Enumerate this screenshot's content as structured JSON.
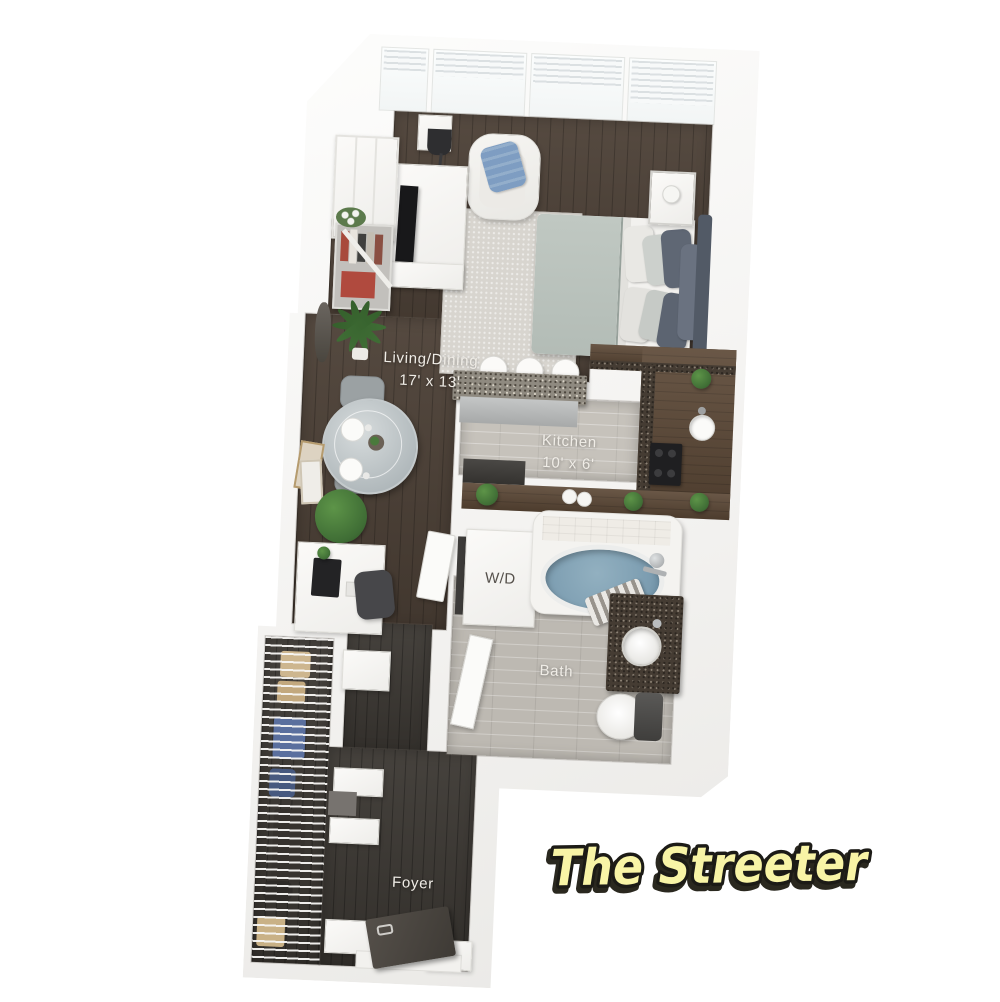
{
  "plan_title": "The Streeter",
  "rooms": {
    "living_dining": {
      "label": "Living/Dining",
      "dimensions": "17' x 13'"
    },
    "kitchen": {
      "label": "Kitchen",
      "dimensions": "10' x 6'"
    },
    "bath": {
      "label": "Bath"
    },
    "foyer": {
      "label": "Foyer"
    },
    "washer_dryer": {
      "label": "W/D"
    }
  },
  "colors": {
    "background": "#ffffff",
    "wall": "#f2f1ef",
    "wood_floor": "#4c4036",
    "foyer_floor": "#3e3a35",
    "kitchen_tile": "#c6c2bb",
    "bath_tile": "#bdb9b2",
    "rug": "#d8d5cf",
    "counter_wood": "#5d4937",
    "granite_light": "#8f8a80",
    "granite_dark": "#453c33",
    "tub_water": "#7b9cb0",
    "bedding_blanket": "#b3bcb6",
    "pillow_dark": "#5c6471",
    "accent_pillow_blue": "#7e9dc2",
    "plant_green": "#3f6d35",
    "title_fill": "#f8f4a6",
    "title_outline": "#1c1b16"
  }
}
